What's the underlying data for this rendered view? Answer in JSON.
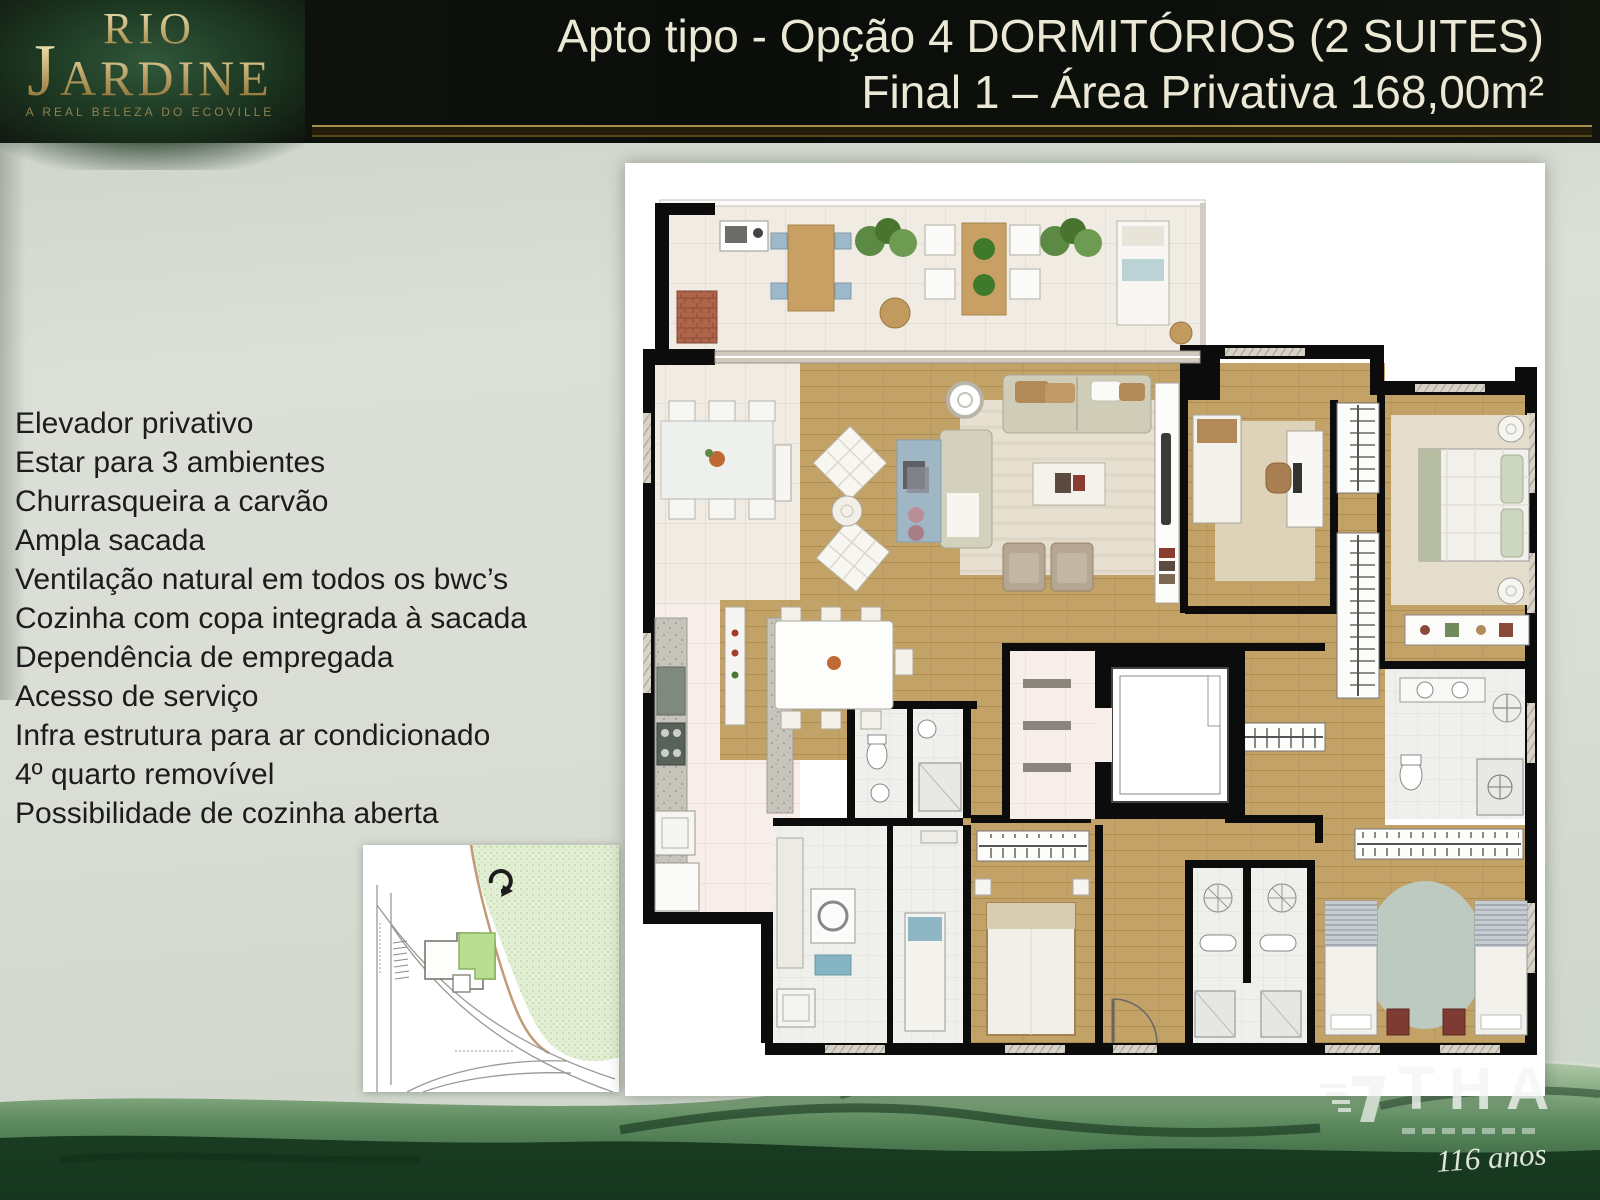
{
  "slide": {
    "header": {
      "logo": {
        "line1": "RIO",
        "line2_initial": "J",
        "line2_rest": "ARDINE",
        "tagline": "A REAL BELEZA DO ECOVILLE"
      },
      "title_line1": "Apto tipo - Opção 4 DORMITÓRIOS (2 SUITES)",
      "title_line2": "Final 1 – Área Privativa 168,00m²"
    },
    "features": [
      "Elevador privativo",
      "Estar para 3 ambientes",
      "Churrasqueira a carvão",
      "Ampla sacada",
      "Ventilação natural em todos os bwc’s",
      "Cozinha com copa integrada à sacada",
      "Dependência de empregada",
      "Acesso de serviço",
      "Infra estrutura para ar condicionado",
      "4º quarto removível",
      "Possibilidade de cozinha aberta"
    ],
    "watermark": {
      "company": "THA",
      "anniversary": "116 anos"
    },
    "colors": {
      "header_bg": "#0b0e0a",
      "logo_green": "#2b4d31",
      "gold_accent": "#a68f4a",
      "title_text": "#ece8d6",
      "feature_text": "#1c1c1c",
      "background": "#d8dcd3",
      "plan_wall": "#0c0c0c",
      "wood_floor": "#c3a267",
      "tile_floor": "#f1ece3",
      "water_green": "#2f5f39",
      "unit_highlight": "#b9de92"
    }
  }
}
